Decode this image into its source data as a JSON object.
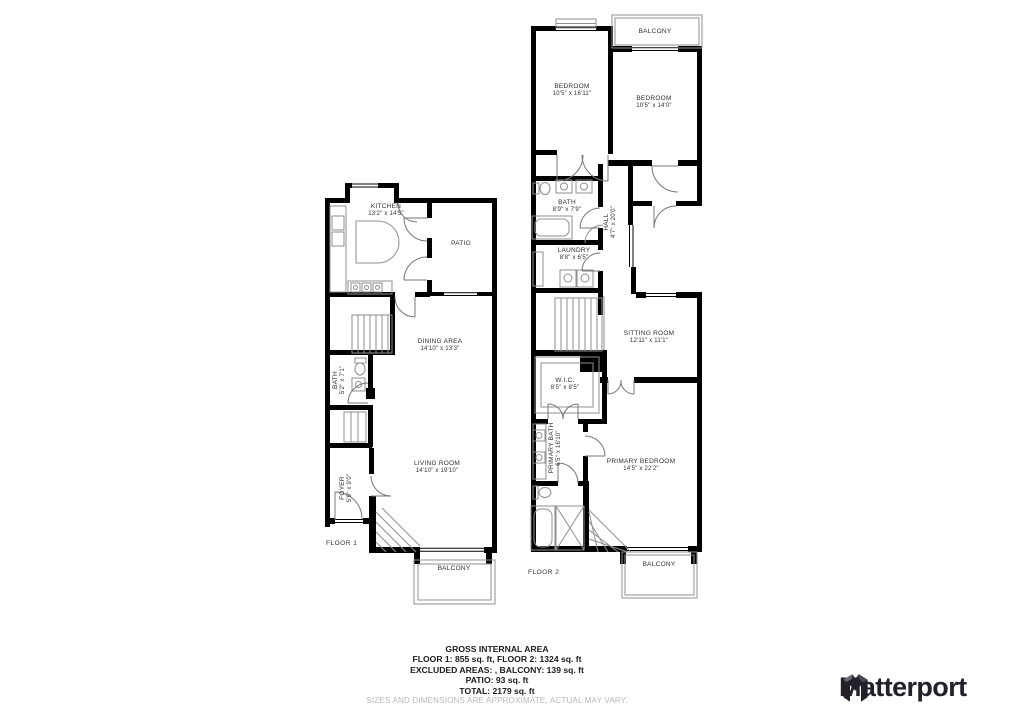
{
  "colors": {
    "wall": "#000000",
    "thin_line": "#8f8f8f",
    "door_arc": "#777777",
    "room_text": "#2f2f2f",
    "summary_text": "#1b1b1b",
    "muted_text": "#b9b9b9",
    "logo": "#232029"
  },
  "floor1": {
    "label": "FLOOR 1",
    "kitchen": {
      "name": "KITCHEN",
      "dims": "13'2\" x 14'5\""
    },
    "patio": {
      "name": "PATIO"
    },
    "dining": {
      "name": "DINING AREA",
      "dims": "14'10\" x 13'3\""
    },
    "bath": {
      "name": "BATH",
      "dims": "5'2\" x 7'1\""
    },
    "foyer": {
      "name": "FOYER",
      "dims": "5'9\" x 9'0\""
    },
    "living": {
      "name": "LIVING ROOM",
      "dims": "14'10\" x 19'10\""
    },
    "balcony": {
      "name": "BALCONY"
    }
  },
  "floor2": {
    "label": "FLOOR 2",
    "balcony_top": {
      "name": "BALCONY"
    },
    "bedroom1": {
      "name": "BEDROOM",
      "dims": "10'5\" x 16'11\""
    },
    "bedroom2": {
      "name": "BEDROOM",
      "dims": "10'5\" x 14'0\""
    },
    "bath": {
      "name": "BATH",
      "dims": "8'9\" x 7'9\""
    },
    "hall": {
      "name": "HALL",
      "dims": "4'7\" x 20'0\""
    },
    "laundry": {
      "name": "LAUNDRY",
      "dims": "8'8\" x 6'5\""
    },
    "sitting": {
      "name": "SITTING ROOM",
      "dims": "12'11\" x 11'1\""
    },
    "wic": {
      "name": "W.I.C.",
      "dims": "8'5\" x 8'5\""
    },
    "primary_bath": {
      "name": "PRIMARY BATH",
      "dims": "6'5\" x 16'10\""
    },
    "primary_bedroom": {
      "name": "PRIMARY BEDROOM",
      "dims": "14'5\" x 22'2\""
    },
    "balcony_bottom": {
      "name": "BALCONY"
    }
  },
  "summary": {
    "title": "GROSS INTERNAL AREA",
    "line1": "FLOOR 1: 855 sq. ft, FLOOR 2: 1324 sq. ft",
    "line2": "EXCLUDED AREAS: , BALCONY: 139 sq. ft",
    "line3": "PATIO: 93 sq. ft",
    "line4": "TOTAL: 2179 sq. ft",
    "disclaimer": "SIZES AND DIMENSIONS ARE APPROXIMATE, ACTUAL MAY VARY."
  },
  "branding": {
    "logo_text": "Matterport",
    "logo_icon": "matterport-m-icon"
  }
}
